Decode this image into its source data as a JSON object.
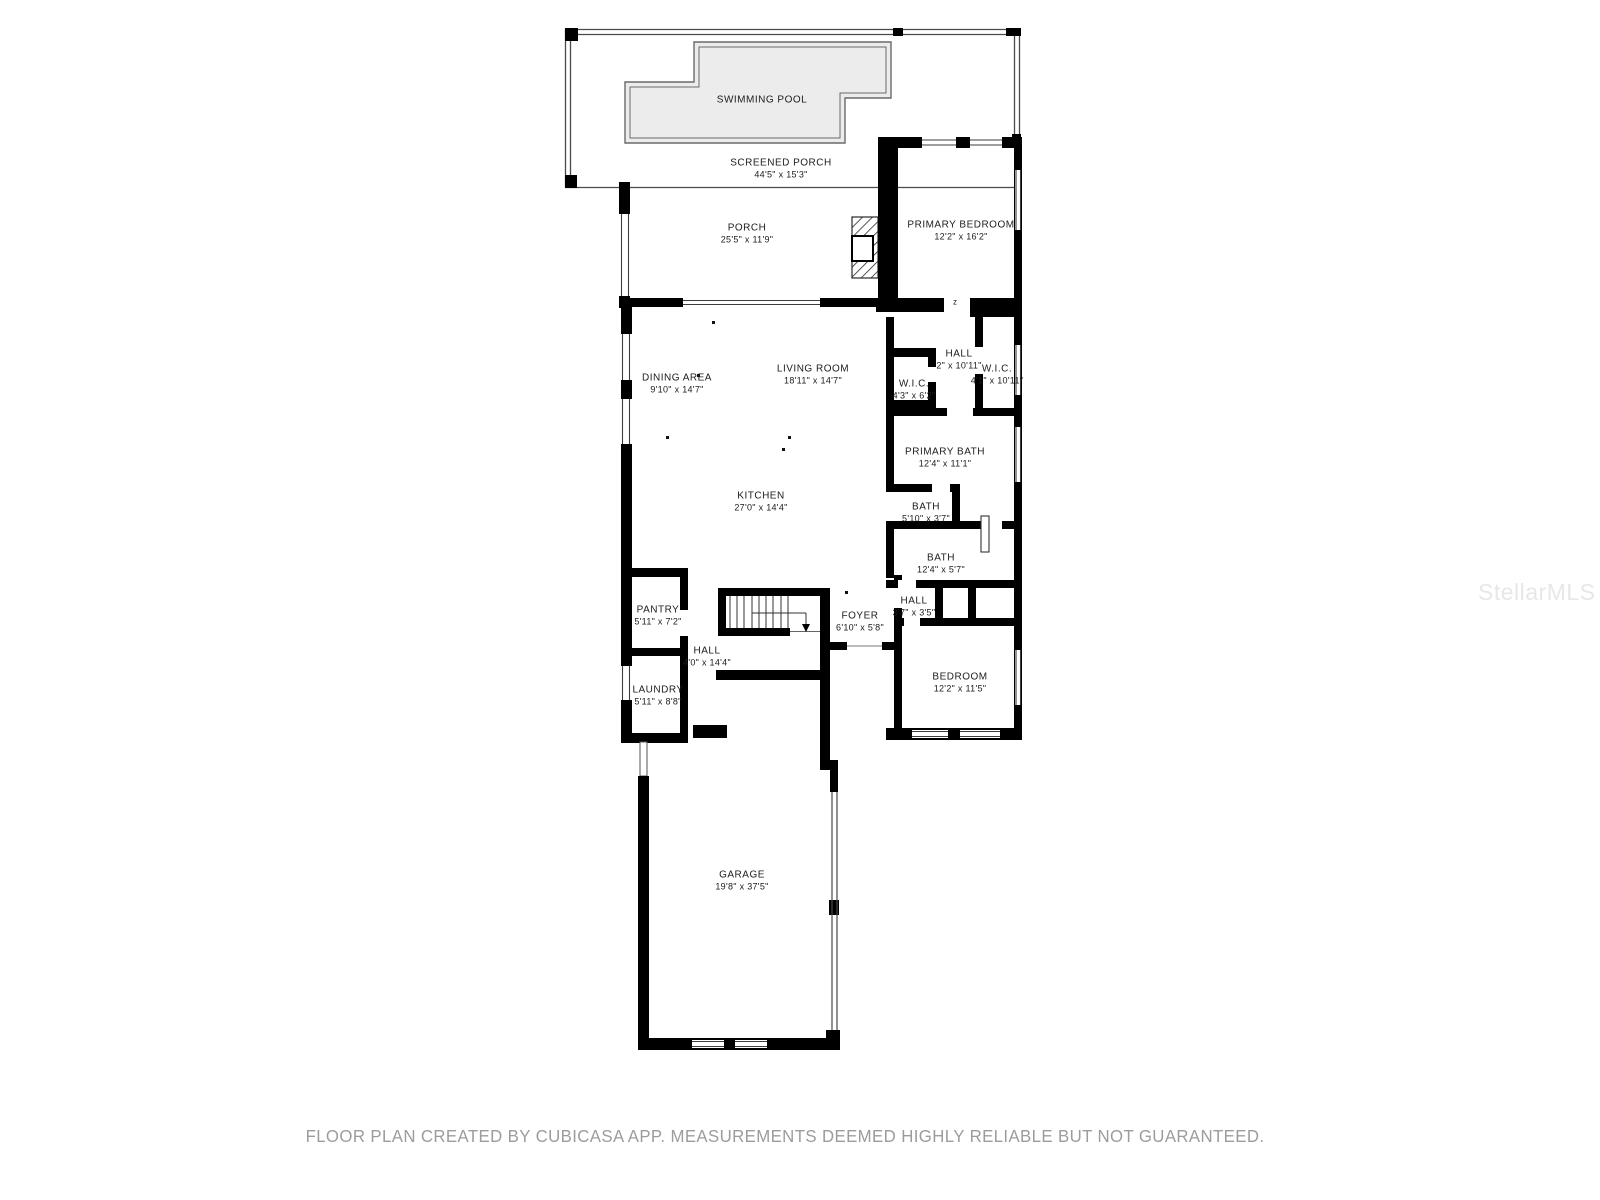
{
  "page": {
    "background": "#ffffff",
    "wall_color": "#000000",
    "pool_fill": "#ececec"
  },
  "watermark": {
    "text": "StellarMLS"
  },
  "footer": {
    "text": "FLOOR PLAN CREATED BY CUBICASA APP. MEASUREMENTS DEEMED HIGHLY RELIABLE BUT NOT GUARANTEED."
  },
  "rooms": {
    "swimming_pool": {
      "name": "SWIMMING POOL",
      "dims": ""
    },
    "screened_porch": {
      "name": "SCREENED PORCH",
      "dims": "44'5\" x 15'3\""
    },
    "porch": {
      "name": "PORCH",
      "dims": "25'5\" x 11'9\""
    },
    "primary_bedroom": {
      "name": "PRIMARY BEDROOM",
      "dims": "12'2\" x 16'2\""
    },
    "dining_area": {
      "name": "DINING AREA",
      "dims": "9'10\" x 14'7\""
    },
    "living_room": {
      "name": "LIVING ROOM",
      "dims": "18'11\" x 14'7\""
    },
    "kitchen": {
      "name": "KITCHEN",
      "dims": "27'0\" x 14'4\""
    },
    "hall_upper": {
      "name": "HALL",
      "dims": "2\" x 10'11\""
    },
    "wic_left": {
      "name": "W.I.C.",
      "dims": "4'3\" x 6'2\""
    },
    "wic_right": {
      "name": "W.I.C.",
      "dims": "4'1\" x 10'11\""
    },
    "primary_bath": {
      "name": "PRIMARY BATH",
      "dims": "12'4\" x 11'1\""
    },
    "bath_small": {
      "name": "BATH",
      "dims": "5'10\" x 3'7\""
    },
    "bath_long": {
      "name": "BATH",
      "dims": "12'4\" x 5'7\""
    },
    "hall_small": {
      "name": "HALL",
      "dims": "3'7\" x 3'5\""
    },
    "foyer": {
      "name": "FOYER",
      "dims": "6'10\" x 5'8\""
    },
    "hall_main": {
      "name": "HALL",
      "dims": "4'0\" x 14'4\""
    },
    "pantry": {
      "name": "PANTRY",
      "dims": "5'11\" x 7'2\""
    },
    "laundry": {
      "name": "LAUNDRY",
      "dims": "5'11\" x 8'8\""
    },
    "bedroom": {
      "name": "BEDROOM",
      "dims": "12'2\" x 11'5\""
    },
    "garage": {
      "name": "GARAGE",
      "dims": "19'8\" x 37'5\""
    }
  },
  "annotations": {
    "door_mark": "z"
  }
}
